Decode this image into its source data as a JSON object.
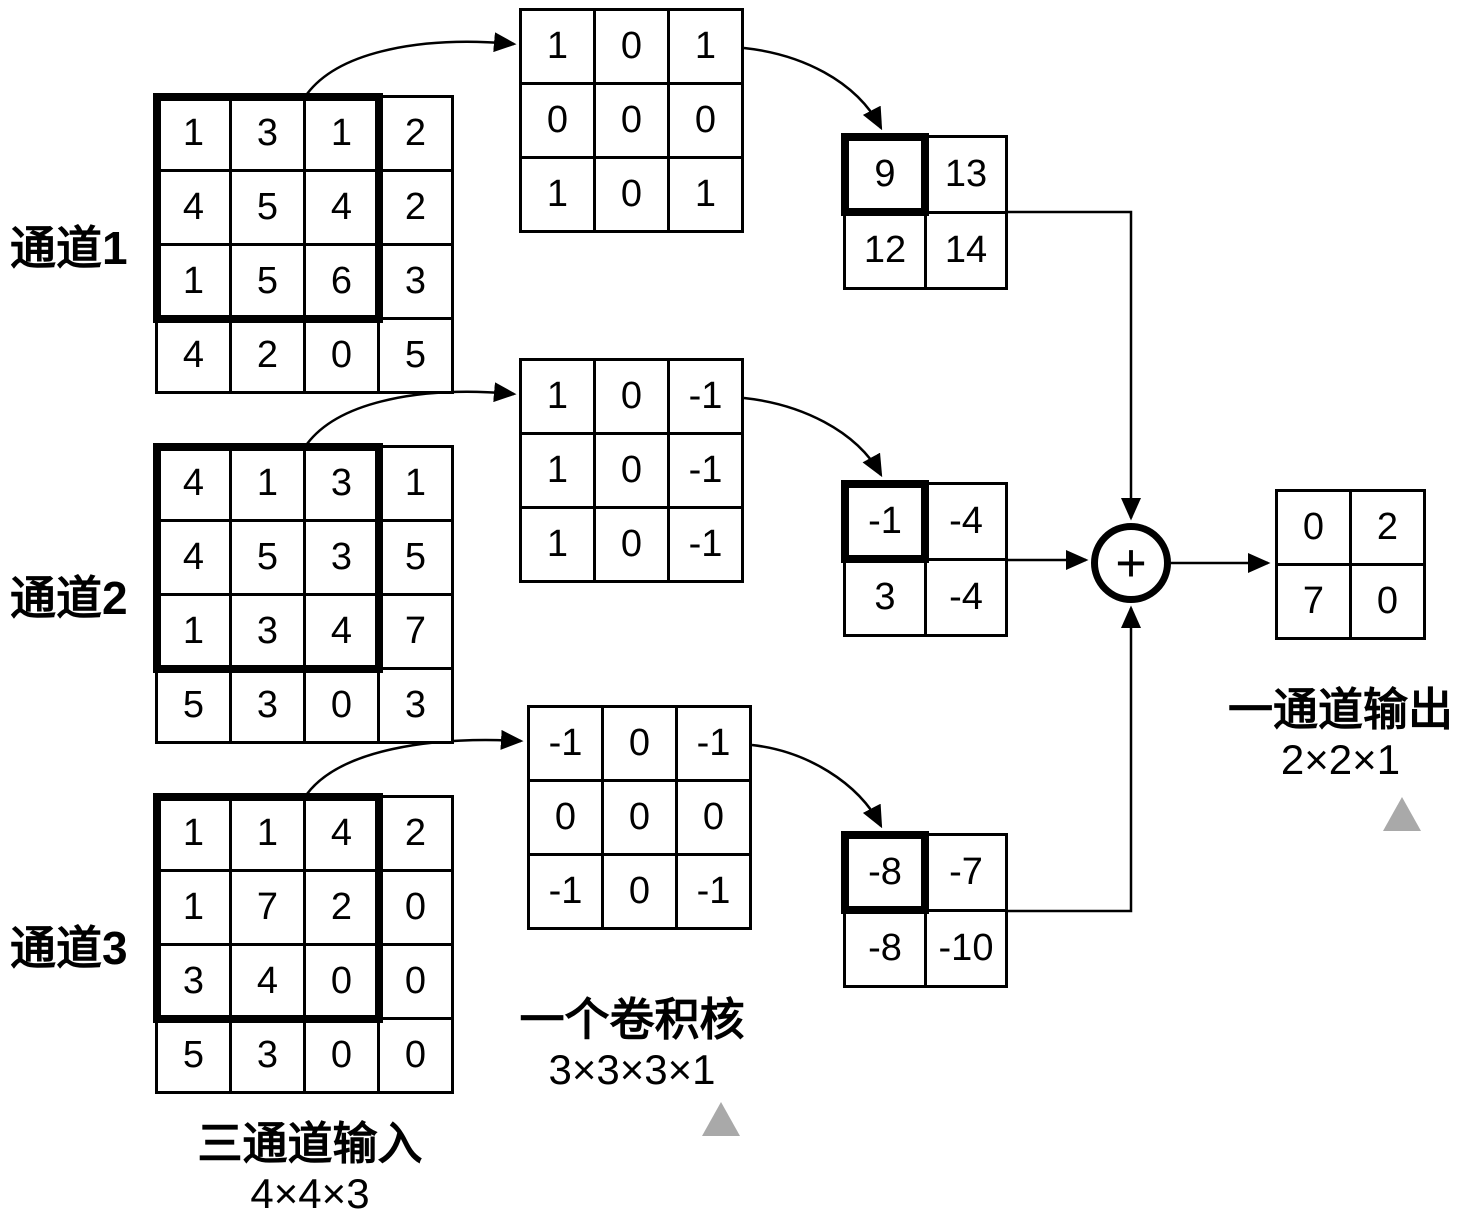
{
  "figure": "multi-channel-convolution-diagram",
  "channels": [
    {
      "label": "通道1",
      "matrix": [
        [
          1,
          3,
          1,
          2
        ],
        [
          4,
          5,
          4,
          2
        ],
        [
          1,
          5,
          6,
          3
        ],
        [
          4,
          2,
          0,
          5
        ]
      ]
    },
    {
      "label": "通道2",
      "matrix": [
        [
          4,
          1,
          3,
          1
        ],
        [
          4,
          5,
          3,
          5
        ],
        [
          1,
          3,
          4,
          7
        ],
        [
          5,
          3,
          0,
          3
        ]
      ]
    },
    {
      "label": "通道3",
      "matrix": [
        [
          1,
          1,
          4,
          2
        ],
        [
          1,
          7,
          2,
          0
        ],
        [
          3,
          4,
          0,
          0
        ],
        [
          5,
          3,
          0,
          0
        ]
      ]
    }
  ],
  "kernels": [
    {
      "matrix": [
        [
          1,
          0,
          1
        ],
        [
          0,
          0,
          0
        ],
        [
          1,
          0,
          1
        ]
      ]
    },
    {
      "matrix": [
        [
          1,
          0,
          -1
        ],
        [
          1,
          0,
          -1
        ],
        [
          1,
          0,
          -1
        ]
      ]
    },
    {
      "matrix": [
        [
          -1,
          0,
          -1
        ],
        [
          0,
          0,
          0
        ],
        [
          -1,
          0,
          -1
        ]
      ]
    }
  ],
  "partials": [
    {
      "matrix": [
        [
          9,
          13
        ],
        [
          12,
          14
        ]
      ]
    },
    {
      "matrix": [
        [
          -1,
          -4
        ],
        [
          3,
          -4
        ]
      ]
    },
    {
      "matrix": [
        [
          -8,
          -7
        ],
        [
          -8,
          -10
        ]
      ]
    }
  ],
  "output": {
    "matrix": [
      [
        0,
        2
      ],
      [
        7,
        0
      ]
    ]
  },
  "labels": {
    "input_title": "三通道输入",
    "input_dims": "4×4×3",
    "kernel_title": "一个卷积核",
    "kernel_dims": "3×3×3×1",
    "output_title": "一通道输出",
    "output_dims": "2×2×1",
    "plus_sign": "+"
  },
  "colors": {
    "stroke": "#000000",
    "background": "#ffffff",
    "triangle_marker": "#a9a9a9"
  }
}
